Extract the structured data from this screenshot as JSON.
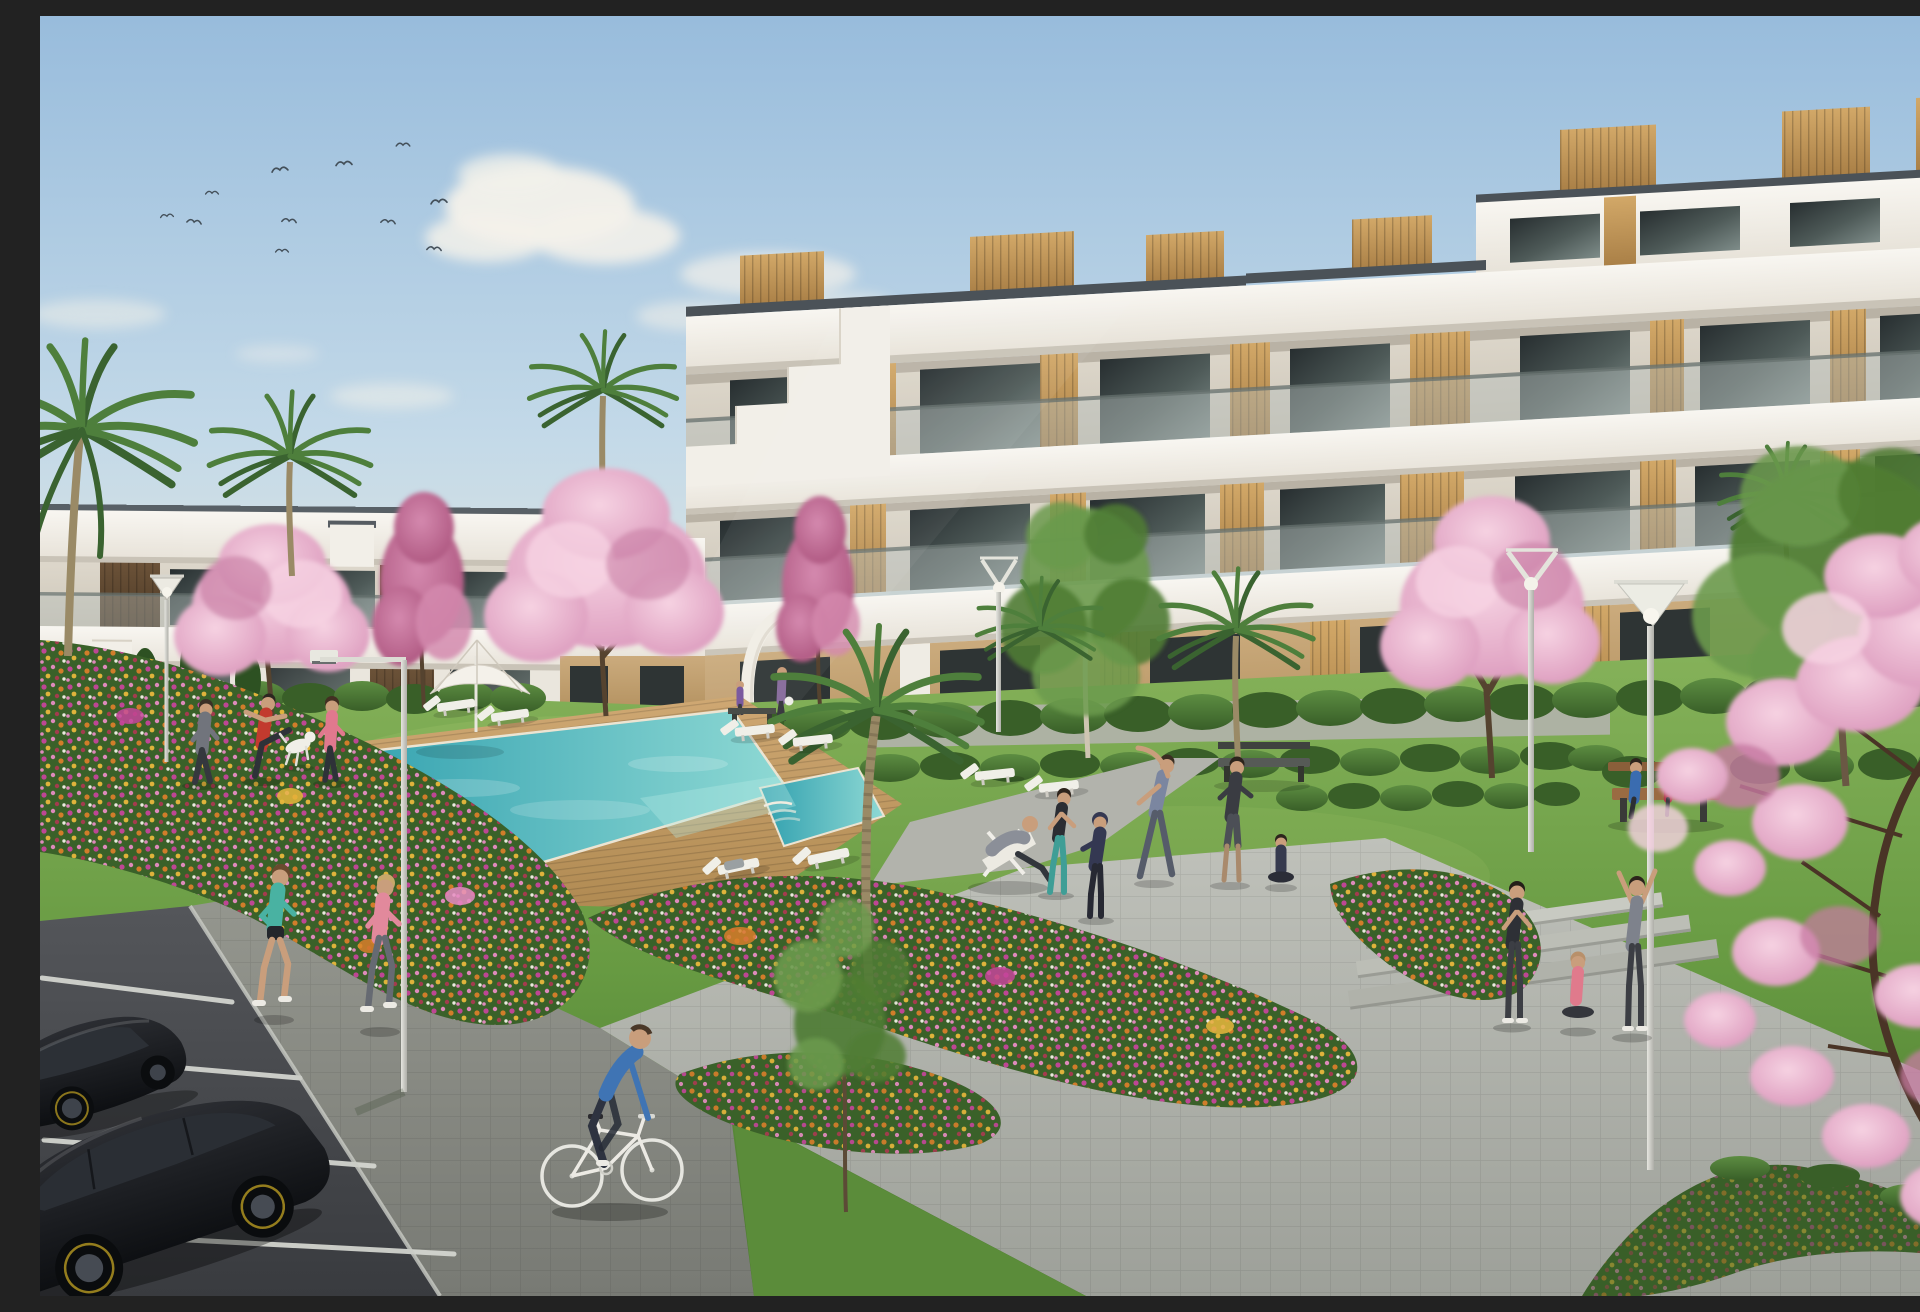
{
  "meta": {
    "title": "Residential complex architectural render",
    "description": "Sunny 3D architectural rendering of a modern white apartment complex with wood-panel accents and glass balconies. Landscaped gardens with cherry-blossom trees, palms and colourful flower beds surround a turquoise swimming pool with timber deck, sun loungers and a white parasol. People exercise on the lawn, two women jog, a man cycles on a paved walkway, couples sit on benches, and two black cars are parked in the foreground lot under a blue sky with birds."
  },
  "scene": {
    "setting": "resort-style apartment complex garden",
    "time_of_day": "daytime, clear sky",
    "counts": {
      "birds": 11,
      "clouds": 12,
      "buildings": 3,
      "palm_trees": 7,
      "cherry_blossom_trees": 6,
      "green_trees": 3,
      "street_lamps": 5,
      "sun_loungers": 8,
      "parasols": 1,
      "benches": 3,
      "pools": 2,
      "flower_beds": 4,
      "people": 19,
      "dogs": 1,
      "cars": 2,
      "bicycles": 1
    },
    "activities": [
      "stretching on lawn",
      "jogging",
      "cycling",
      "lounging on deckchair",
      "sitting on bench",
      "yoga",
      "walking a dog"
    ]
  },
  "colors": {
    "sky_top": "#98bcdc",
    "sky_mid": "#c3d9e8",
    "sky_horizon": "#dfe6e2",
    "sky_warm": "#e9e9e0",
    "cloud": "#f3f1ea",
    "bird": "#44505a",
    "building_white": "#f8f6f1",
    "building_shade": "#e7e2d8",
    "recess_light": "#ddd7cb",
    "recess_dark": "#cdc6b8",
    "fascia": "#4b5258",
    "under_shadow": "#c9c3b7",
    "glass_dark": "#272e30",
    "glass_mid": "#4e5a58",
    "glass_light": "#7e8c89",
    "wood_light": "#d2a868",
    "wood_dark": "#a97f46",
    "darkwood_light": "#6b5238",
    "darkwood_dark": "#4e3a26",
    "beige_light": "#cbab7d",
    "beige_dark": "#b2905e",
    "balustrade": "#b7c1bf",
    "rail": "#65706e",
    "grass_light": "#86b25a",
    "grass_mid": "#679a42",
    "grass_dark": "#47742c",
    "grass_glow": "#d8e890",
    "hedge_light": "#5d8d42",
    "hedge_dark": "#395f28",
    "cypress": "#2d5122",
    "pool_deep": "#2f9fae",
    "pool_shallow": "#8fd9d4",
    "pool_foam": "#b6ece4",
    "deck_light": "#cfa873",
    "deck_dark": "#b08a52",
    "plaza_light": "#bfc1ba",
    "plaza_dark": "#9da099",
    "walkway": "#b2b3ac",
    "side_light": "#95978f",
    "side_dark": "#787a74",
    "asphalt_light": "#54565a",
    "asphalt_dark": "#393b3f",
    "line_white": "#d6d8d2",
    "lamp_light": "#e6e6e0",
    "lamp_dark": "#aeaea8",
    "car_light": "#2b2d32",
    "car_dark": "#0d0f12",
    "rim_yellow": "#b79a22",
    "blossom_light": "#f6d2e2",
    "blossom": "#d893b8",
    "blossom_deep": "#c77ba2",
    "magenta_light": "#d489ae",
    "magenta_dark": "#a84f79",
    "palm_green": "#4e7f3c",
    "palm_dark": "#3a6330",
    "tree_green": "#4f7c34",
    "tree_green_light": "#6b9a4c",
    "birch_trunk": "#cfc5b2",
    "trunk": "#55432f",
    "trunk_gray": "#6a5844",
    "flower_magenta": "#c5459a",
    "flower_pink": "#e78cc3",
    "flower_orange": "#d97e2a",
    "flower_gold": "#e8b73c",
    "flower_red": "#a93a50",
    "flower_white": "#f3f0e8",
    "skin": "#c99e7c",
    "white_soft": "#f0efe8"
  }
}
